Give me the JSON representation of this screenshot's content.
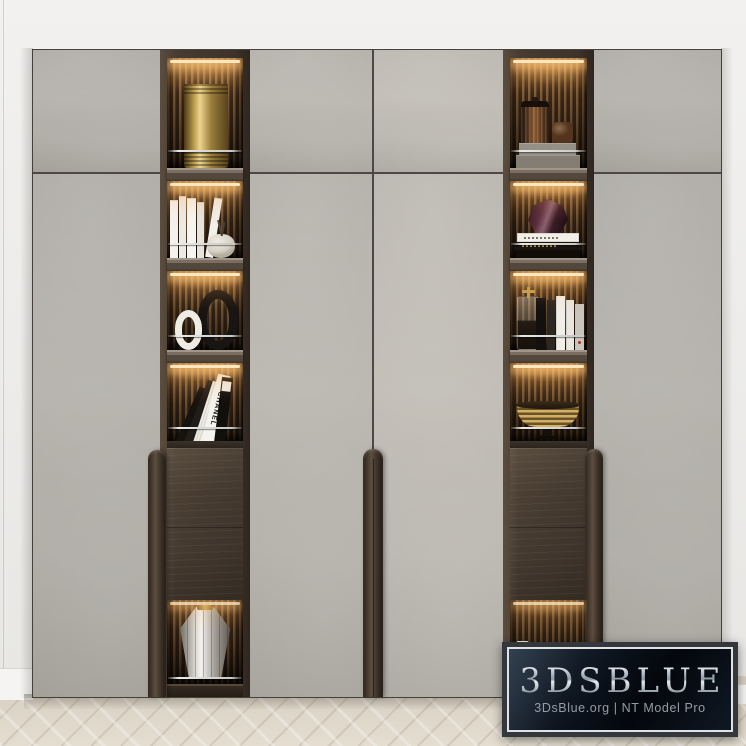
{
  "watermark": {
    "brand": "3DSBLUE",
    "subtitle": "3DsBlue.org | NT Model Pro"
  },
  "decor_text": {
    "chanel_book_spine": "CHANEL"
  },
  "palette": {
    "wall": "#f1f0ee",
    "door_greige": "#b6b3ac",
    "seam": "#4d4843",
    "frame_wood": "#483c30",
    "drawer_wood": "#4b3f34",
    "slat_lit": "#7d5d39",
    "led_glow": "#ffd9a0",
    "brass": "#c3a35c",
    "floor_oak": "#dcd4c8",
    "badge_bg": "#0a111b",
    "badge_border": "#dfe3e6",
    "badge_title_silver": "#c9d1d9",
    "badge_subtitle_gray": "#959ca5"
  },
  "cabinet": {
    "doors": [
      "upper-left",
      "upper-center-left",
      "upper-center-right",
      "upper-right",
      "lower-left",
      "lower-center-left",
      "lower-center-right",
      "lower-right"
    ],
    "handles": [
      "left-vertical-handle",
      "center-vertical-handle",
      "right-vertical-handle"
    ],
    "columns": [
      {
        "side": "left",
        "shelves": [
          [
            "brass-cylinder-canister"
          ],
          [
            "white-book-set",
            "cream-vase-with-sprig"
          ],
          [
            "white-ring-vase",
            "black-ring-vase"
          ],
          [
            "leaning-fashion-books",
            "chanel-book"
          ],
          [
            "wood-drawer-front"
          ],
          [
            "faceted-silver-vase"
          ]
        ]
      },
      {
        "side": "right",
        "shelves": [
          [
            "smoked-glass-jar-large",
            "smoked-glass-jar-small",
            "concrete-box-stack"
          ],
          [
            "plum-faceted-vase",
            "stacked-books"
          ],
          [
            "glass-decanter-gold-stopper",
            "standing-books"
          ],
          [
            "brass-ribbed-bowl"
          ],
          [
            "wood-drawer-front"
          ],
          [
            "white-books",
            "brass-wire-basket"
          ]
        ]
      }
    ]
  }
}
